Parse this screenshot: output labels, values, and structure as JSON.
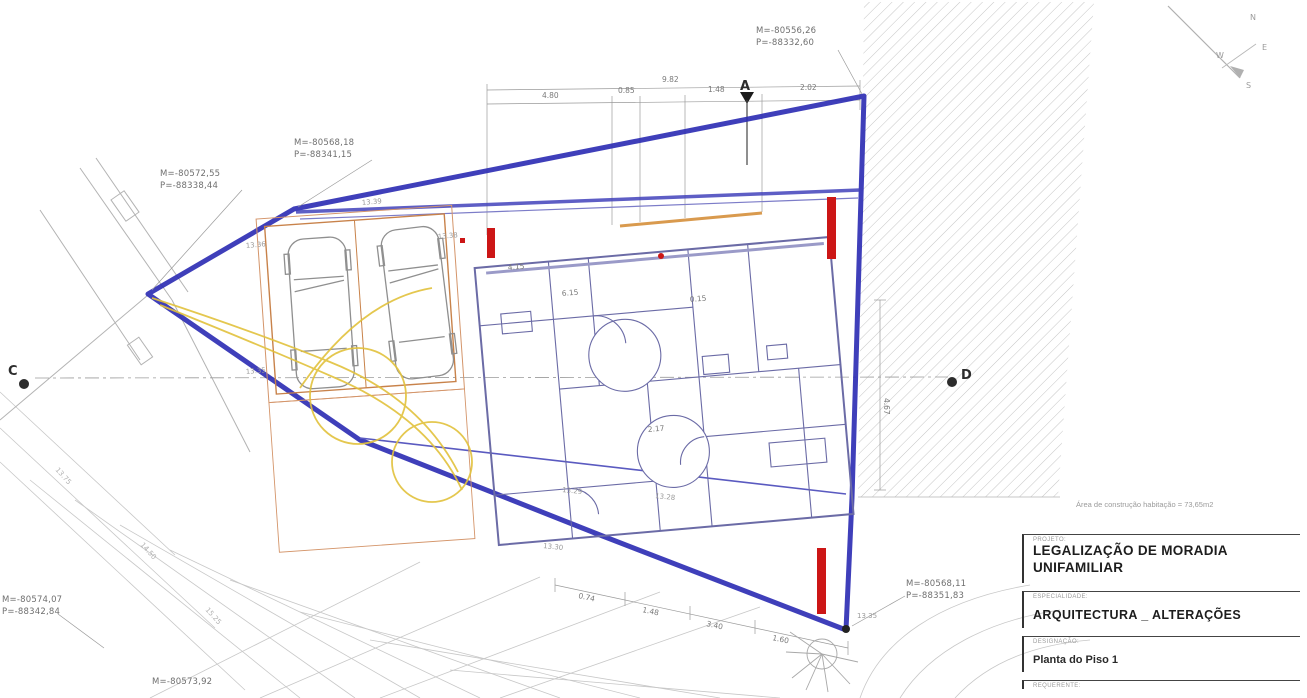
{
  "drawing": {
    "type": "architectural-site-plan",
    "area_note": "Área de construção habitação = 73,65m2"
  },
  "colors": {
    "boundary_blue": "#2a2ab2",
    "wall_navy": "#6b6ba6",
    "alteration_red": "#cc1616",
    "parking_orange": "#c8824a",
    "circulation_yellow": "#e2c23c",
    "hatch_grey": "#c4c4c4",
    "text_grey": "#6f6f6f"
  },
  "compass": {
    "n": "N",
    "e": "E",
    "s": "S",
    "w": "W"
  },
  "section_markers": {
    "a": "A",
    "c": "C",
    "d": "D"
  },
  "survey_points": [
    {
      "m": "M=-80556,26",
      "p": "P=-88332,60"
    },
    {
      "m": "M=-80568,18",
      "p": "P=-88341,15"
    },
    {
      "m": "M=-80572,55",
      "p": "P=-88338,44"
    },
    {
      "m": "M=-80574,07",
      "p": "P=-88342,84"
    },
    {
      "m": "M=-80573,92",
      "p": ""
    },
    {
      "m": "M=-80568,11",
      "p": "P=-88351,83"
    }
  ],
  "dimensions": {
    "overall_top": "9.82",
    "top_segments": [
      "4.80",
      "0.85",
      "1.48",
      "2.02"
    ],
    "interior": [
      "4.15",
      "6.15",
      "0.15",
      "2.17",
      "4.67"
    ],
    "bottom_segments": [
      "0.74",
      "1.48",
      "3.40",
      "1.60"
    ]
  },
  "spot_elevations": [
    "13.39",
    "13.38",
    "13.36",
    "13.35",
    "13.30",
    "13.29",
    "13.28",
    "13.35"
  ],
  "contour_labels": [
    "13.75",
    "14.50",
    "15.25"
  ],
  "title_block": {
    "sections": [
      {
        "label": "PROJETO:",
        "value_line1": "LEGALIZAÇÃO DE MORADIA",
        "value_line2": "UNIFAMILIAR"
      },
      {
        "label": "ESPECIALIDADE:",
        "value": "ARQUITECTURA _ ALTERAÇÕES"
      },
      {
        "label": "DESIGNAÇÃO:",
        "value": "Planta do Piso 1"
      },
      {
        "label": "REQUERENTE:",
        "value": ""
      }
    ]
  }
}
